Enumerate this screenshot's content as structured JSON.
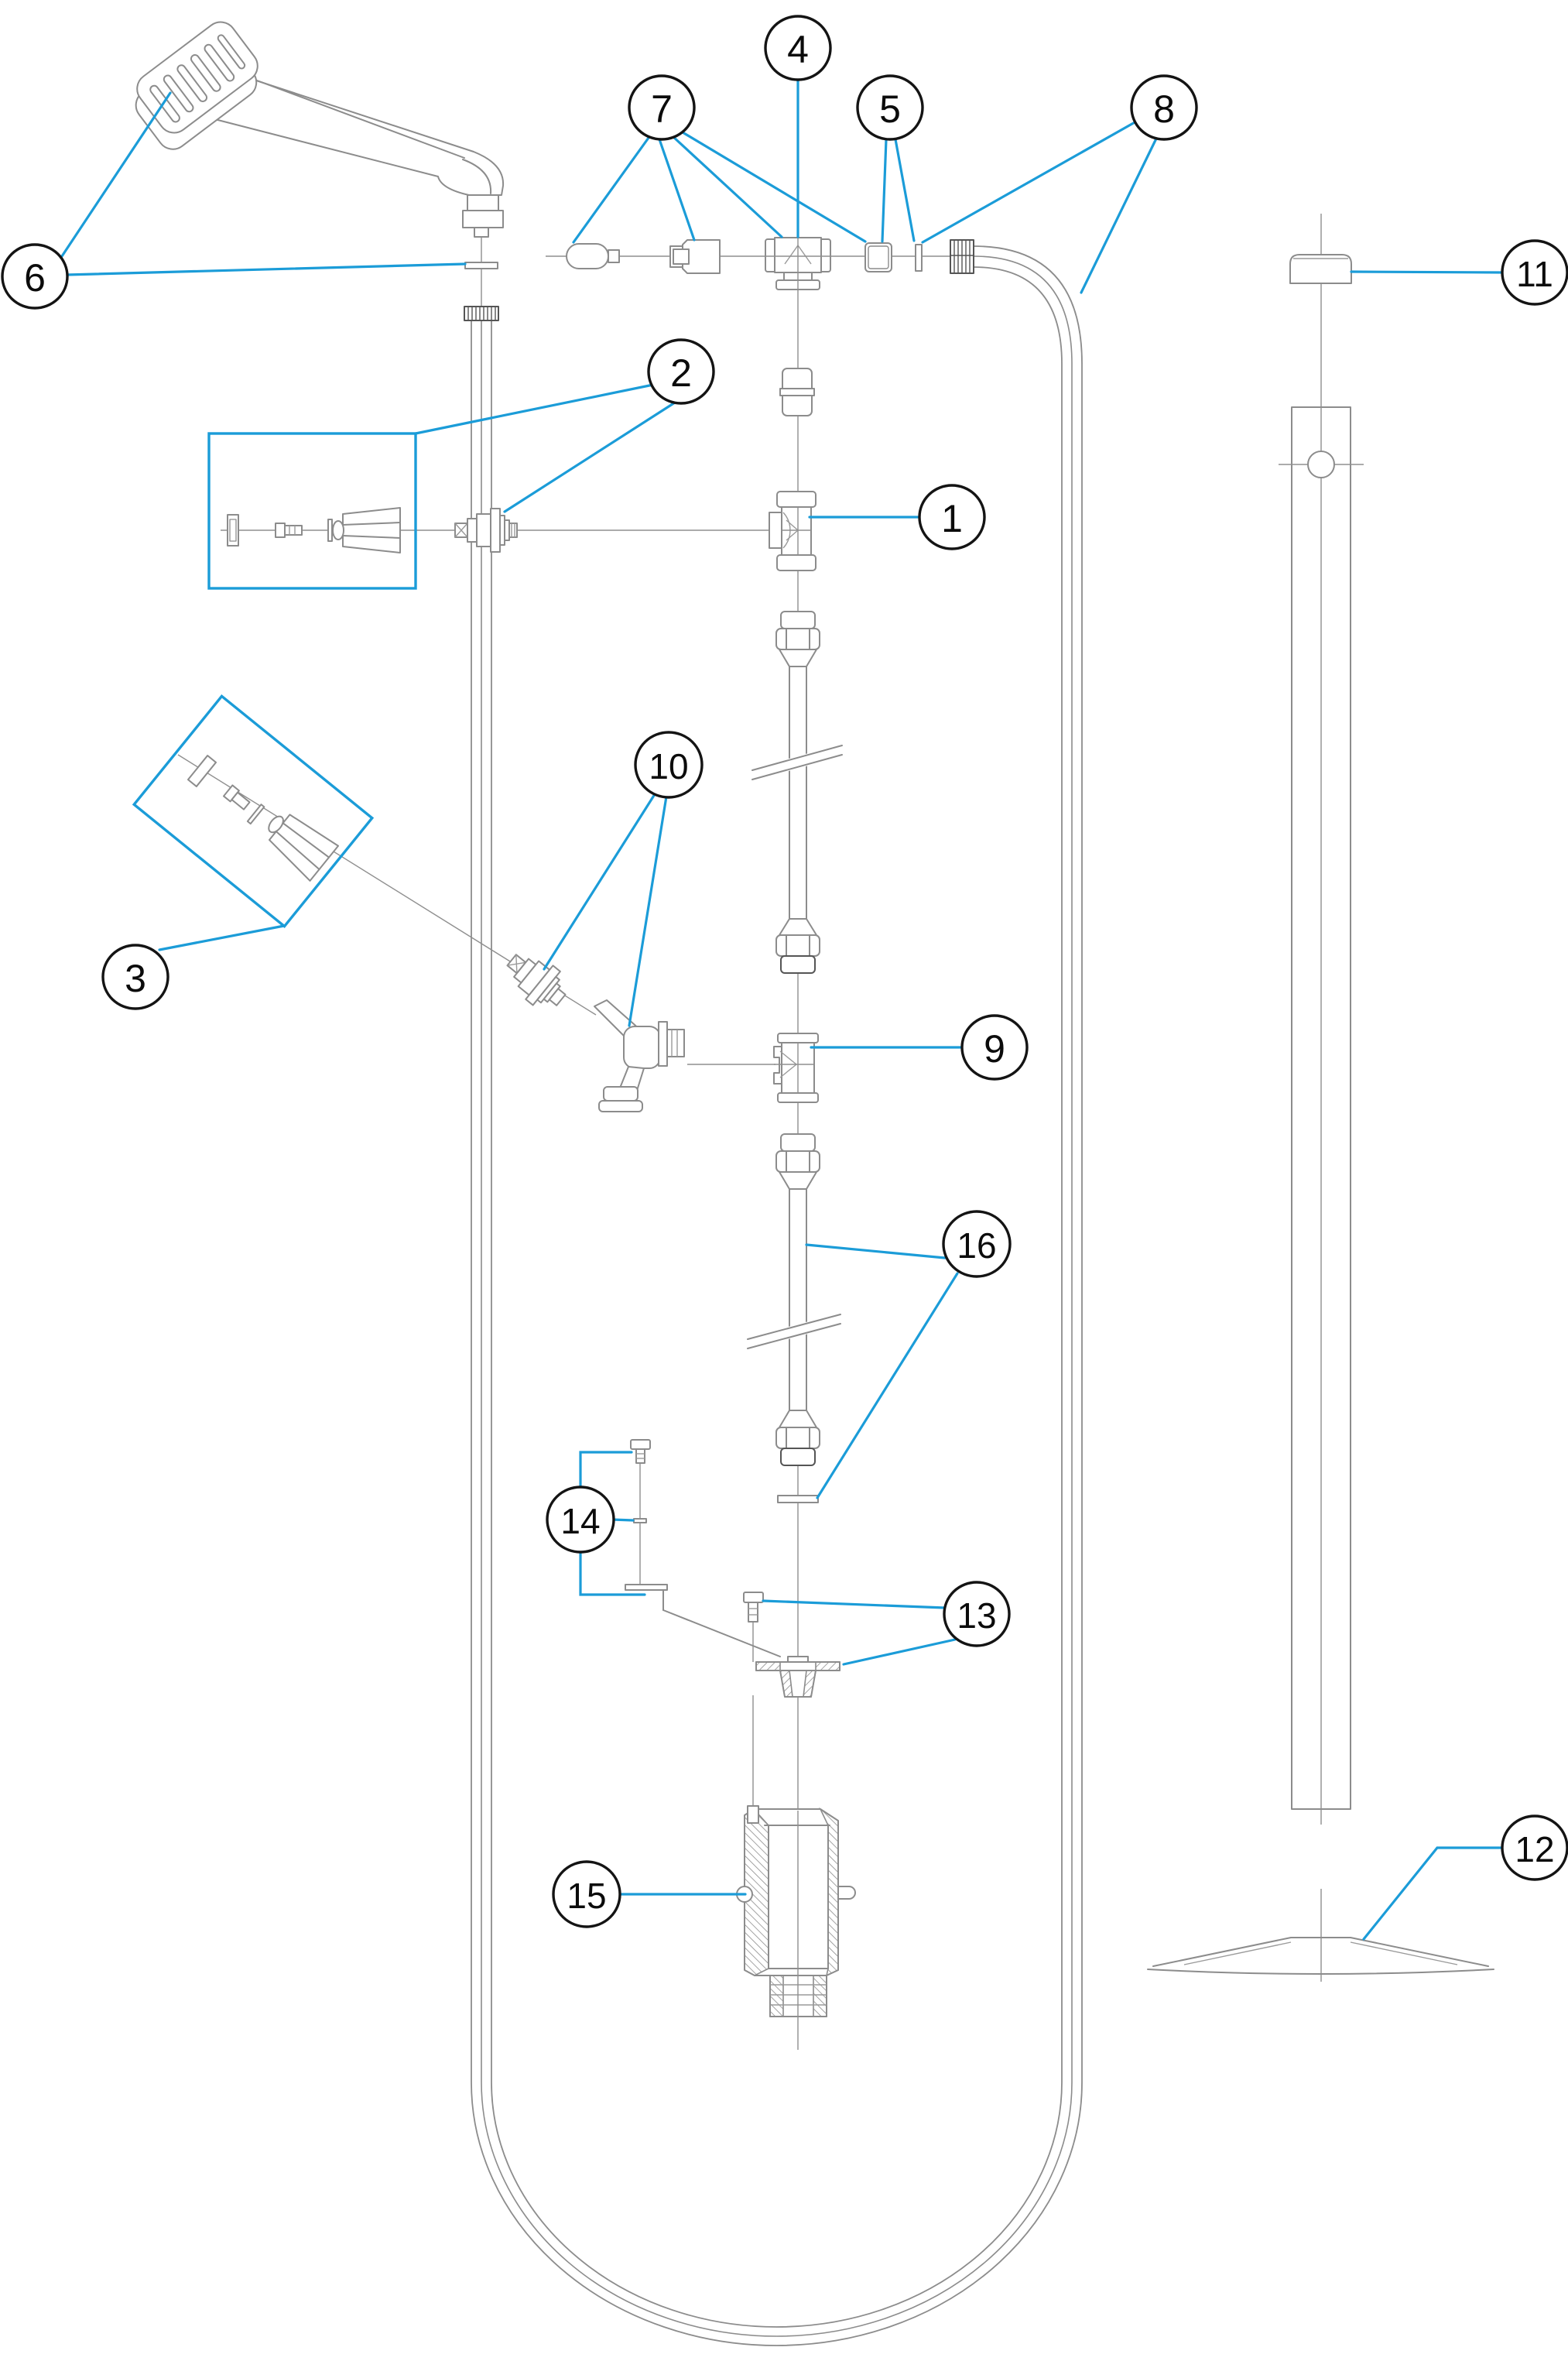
{
  "diagram": {
    "kind": "exploded-parts-diagram",
    "callouts": [
      {
        "label": "1"
      },
      {
        "label": "2"
      },
      {
        "label": "3"
      },
      {
        "label": "4"
      },
      {
        "label": "5"
      },
      {
        "label": "6"
      },
      {
        "label": "7"
      },
      {
        "label": "8"
      },
      {
        "label": "9"
      },
      {
        "label": "10"
      },
      {
        "label": "11"
      },
      {
        "label": "12"
      },
      {
        "label": "13"
      },
      {
        "label": "14"
      },
      {
        "label": "15"
      },
      {
        "label": "16"
      }
    ],
    "colors": {
      "leader_blue": "#1B9CD8",
      "linework_gray": "#8C8C8C",
      "callout_stroke": "#141414",
      "background": "#FFFFFF"
    }
  }
}
